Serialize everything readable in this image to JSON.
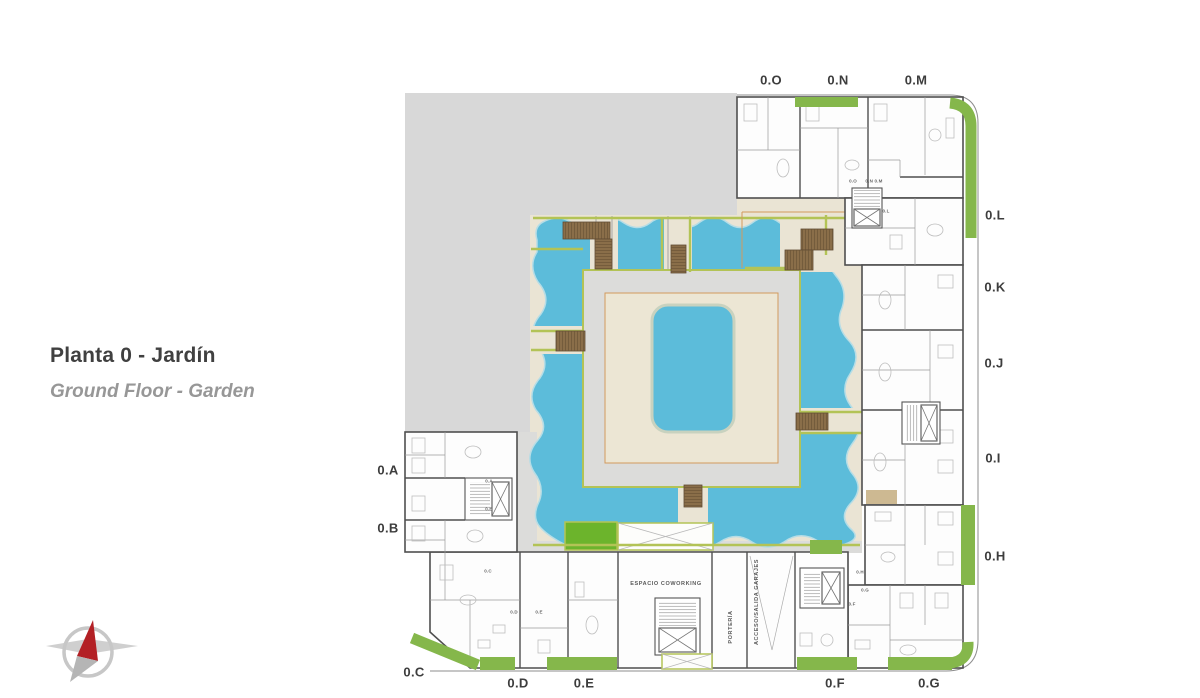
{
  "title": {
    "main": "Planta 0 - Jardín",
    "sub": "Ground Floor - Garden"
  },
  "plan": {
    "units": [
      {
        "id": "0O",
        "text": "0.O"
      },
      {
        "id": "0N",
        "text": "0.N"
      },
      {
        "id": "0M",
        "text": "0.M"
      },
      {
        "id": "0L",
        "text": "0.L"
      },
      {
        "id": "0K",
        "text": "0.K"
      },
      {
        "id": "0J",
        "text": "0.J"
      },
      {
        "id": "0I",
        "text": "0.I"
      },
      {
        "id": "0H",
        "text": "0.H"
      },
      {
        "id": "0A",
        "text": "0.A"
      },
      {
        "id": "0B",
        "text": "0.B"
      },
      {
        "id": "0C",
        "text": "0.C"
      },
      {
        "id": "0D",
        "text": "0.D"
      },
      {
        "id": "0E",
        "text": "0.E"
      },
      {
        "id": "0F",
        "text": "0.F"
      },
      {
        "id": "0G",
        "text": "0.G"
      }
    ],
    "rooms": {
      "coworking": "ESPACIO COWORKING",
      "porteria": "PORTERÍA",
      "garage": "ACCESO/SALIDA GARAJES"
    },
    "door_tags": [
      {
        "text": "0.A"
      },
      {
        "text": "0.B"
      },
      {
        "text": "0.C"
      },
      {
        "text": "0.D"
      },
      {
        "text": "0.E"
      },
      {
        "text": "0.F"
      },
      {
        "text": "0.G"
      },
      {
        "text": "0.H"
      },
      {
        "text": "0.O"
      },
      {
        "text": "0.N 0.M"
      },
      {
        "text": "0.L"
      }
    ]
  },
  "colors": {
    "bg": "#ffffff",
    "gray_block": "#d8d8d8",
    "building": "#fdfdfd",
    "wall": "#4f4f4f",
    "partition": "#9a9a9a",
    "furniture": "#bdbdbd",
    "courtyard": "#eae4d4",
    "walkway": "#dcdcda",
    "water": "#5cbcda",
    "water_rim": "#b6dde6",
    "deck": "#ece6d4",
    "deck_line": "#d29a5d",
    "olive": "#b3c356",
    "lawn": "#6cb42c",
    "terrace_green": "#85b74b",
    "bridge": "#8a6e49",
    "bridge_line": "#5f4a32",
    "label": "#3d3d3d",
    "tag": "#666666",
    "title": "#404040",
    "subtitle": "#979797",
    "compass_red": "#b32025",
    "compass_gray": "#c7c7c7"
  }
}
